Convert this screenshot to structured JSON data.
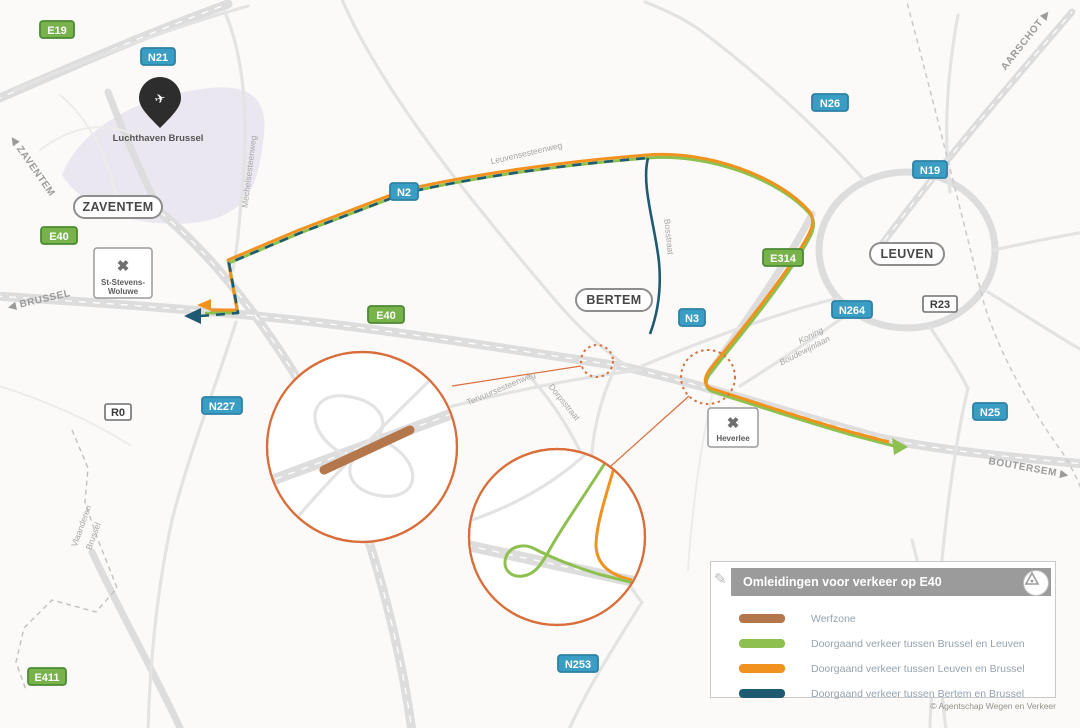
{
  "map": {
    "shields": [
      {
        "label": "E19",
        "type": "green"
      },
      {
        "label": "N21",
        "type": "blue"
      },
      {
        "label": "N26",
        "type": "blue"
      },
      {
        "label": "N19",
        "type": "blue"
      },
      {
        "label": "E40",
        "type": "green"
      },
      {
        "label": "N2",
        "type": "blue"
      },
      {
        "label": "E40",
        "type": "green"
      },
      {
        "label": "E314",
        "type": "green"
      },
      {
        "label": "N3",
        "type": "blue"
      },
      {
        "label": "N264",
        "type": "blue"
      },
      {
        "label": "R23",
        "type": "white"
      },
      {
        "label": "R0",
        "type": "white"
      },
      {
        "label": "N227",
        "type": "blue"
      },
      {
        "label": "N25",
        "type": "blue"
      },
      {
        "label": "N253",
        "type": "blue"
      },
      {
        "label": "E411",
        "type": "green"
      }
    ],
    "towns": [
      {
        "label": "ZAVENTEM"
      },
      {
        "label": "BERTEM"
      },
      {
        "label": "LEUVEN"
      }
    ],
    "interchanges": [
      {
        "line1": "St-Stevens-",
        "line2": "Woluwe"
      },
      {
        "line1": "Heverlee",
        "line2": ""
      }
    ],
    "directions": [
      {
        "label": "◀ ZAVENTEM"
      },
      {
        "label": "◀ BRUSSEL"
      },
      {
        "label": "AARSCHOT ▶"
      },
      {
        "label": "BOUTERSEM ▶"
      }
    ],
    "streets": [
      {
        "label": "Mechelsesteenweg"
      },
      {
        "label": "Leuvensesteenweg"
      },
      {
        "label": "Bosstraat"
      },
      {
        "label": "Tervuursesteenweg"
      },
      {
        "label": "Dorpsstraat"
      },
      {
        "label": "Koning"
      },
      {
        "label": "Boudewijnlaan"
      }
    ],
    "boundary_labels": [
      {
        "label": "Vlaanderen"
      },
      {
        "label": "Brussel"
      }
    ],
    "airport": {
      "label": "Luchthaven Brussel"
    }
  },
  "legend": {
    "title": "Omleidingen voor verkeer op E40",
    "items": [
      {
        "label": "Werfzone",
        "color": "#b4764b"
      },
      {
        "label": "Doorgaand verkeer tussen Brussel en Leuven",
        "color": "#8dc04f"
      },
      {
        "label": "Doorgaand verkeer tussen Leuven en Brussel",
        "color": "#f1921f"
      },
      {
        "label": "Doorgaand verkeer tussen Bertem en Brussel",
        "color": "#1e5b72"
      }
    ],
    "copyright": "© Agentschap Wegen en Verkeer"
  },
  "colors": {
    "route_green": "#8dc04f",
    "route_orange": "#f1921f",
    "route_navy": "#1e5b72",
    "werfzone": "#b4764b",
    "inset_orange": "#d96e3a",
    "shield_green": "#77b24a",
    "shield_green_border": "#4c8a33",
    "shield_blue": "#3a9dc4",
    "shield_blue_border": "#2e81a5",
    "road": "#e3e3e3",
    "road_wide": "#dddddd",
    "rail": "#c9c9c9",
    "boundary": "#c0c0c0",
    "town_border": "#8d8d8d",
    "town_text": "#474747",
    "dir_text": "#9b9b9b",
    "street_text": "#a6a6a6",
    "airport_fill": "#ebe7f1",
    "pin": "#2d2d2d",
    "legend_bar": "#9b9b9b",
    "legend_text": "#95a3b0",
    "box_border": "#c9c9c9",
    "copyright": "#96918a"
  }
}
